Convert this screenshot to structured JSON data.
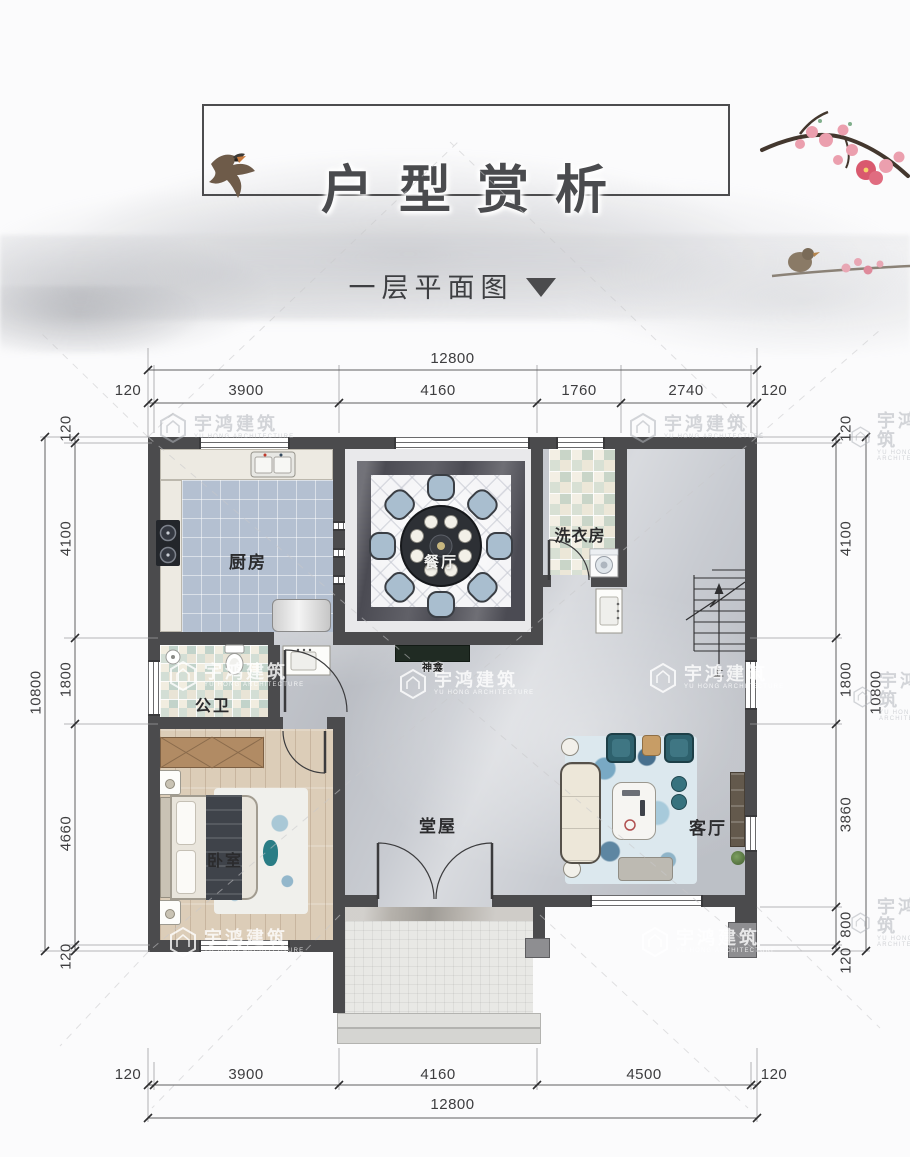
{
  "header": {
    "title": "户型赏析",
    "subtitle": "一层平面图"
  },
  "watermark": {
    "name": "宇鸿建筑",
    "sub": "YU HONG ARCHITECTURE"
  },
  "rooms": {
    "kitchen": "厨房",
    "dining": "餐厅",
    "laundry": "洗衣房",
    "bathroom": "公卫",
    "bedroom": "卧室",
    "hall": "堂屋",
    "living": "客厅",
    "shrine": "神龛",
    "stairs_up": "上"
  },
  "dimensions": {
    "top_total": "12800",
    "top_segments": [
      "120",
      "3900",
      "4160",
      "1760",
      "2740",
      "120"
    ],
    "bottom_segments": [
      "120",
      "3900",
      "4160",
      "4500",
      "120"
    ],
    "bottom_total": "12800",
    "left_total": "10800",
    "left_segments": [
      "120",
      "4100",
      "1800",
      "4660",
      "120"
    ],
    "right_segments": [
      "120",
      "4100",
      "1800",
      "3860",
      "800",
      "120"
    ],
    "right_total": "10800"
  },
  "colors": {
    "wall": "#4b4b4d",
    "kitchen_tile": "#b4c0d1",
    "chair_blue": "#a9becf",
    "armchair_teal": "#2e616d"
  }
}
